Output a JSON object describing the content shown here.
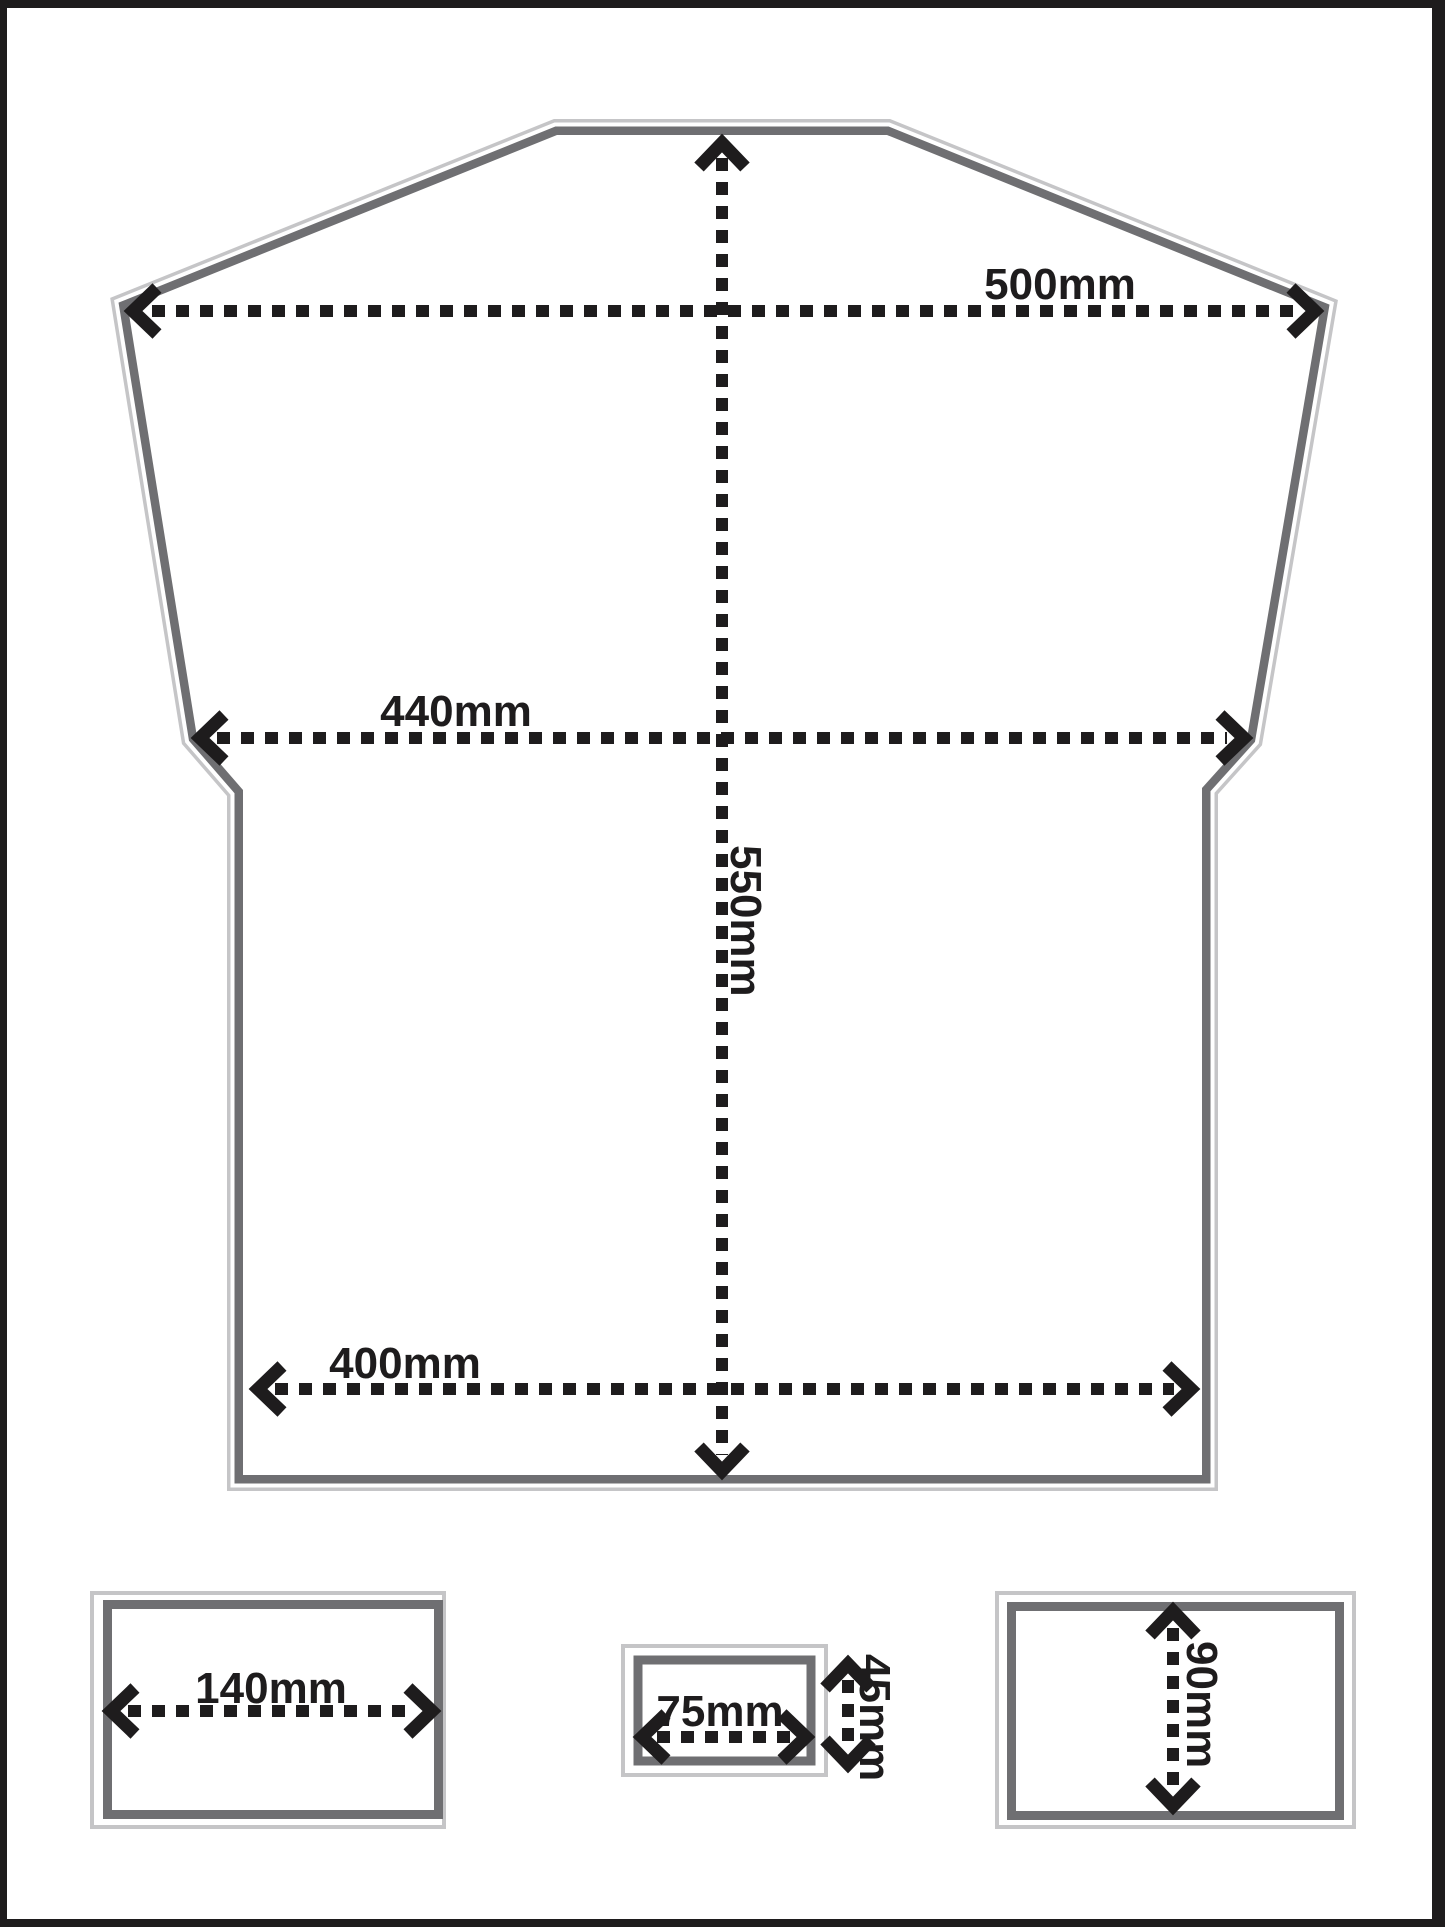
{
  "diagram": {
    "title_hint": "garment panel dimension drawing",
    "dimensions": {
      "top_width": "500mm",
      "chest_width": "440mm",
      "length": "550mm",
      "hem_width": "400mm",
      "left_box_width": "140mm",
      "center_box_width": "75mm",
      "center_box_height": "45mm",
      "right_box_height": "90mm"
    },
    "colors": {
      "outline_dark": "#6f6f72",
      "outline_light": "#c5c5c7",
      "dimension_black": "#1e1c1d",
      "frame_black": "#1e1c1d",
      "background": "#ffffff"
    }
  }
}
